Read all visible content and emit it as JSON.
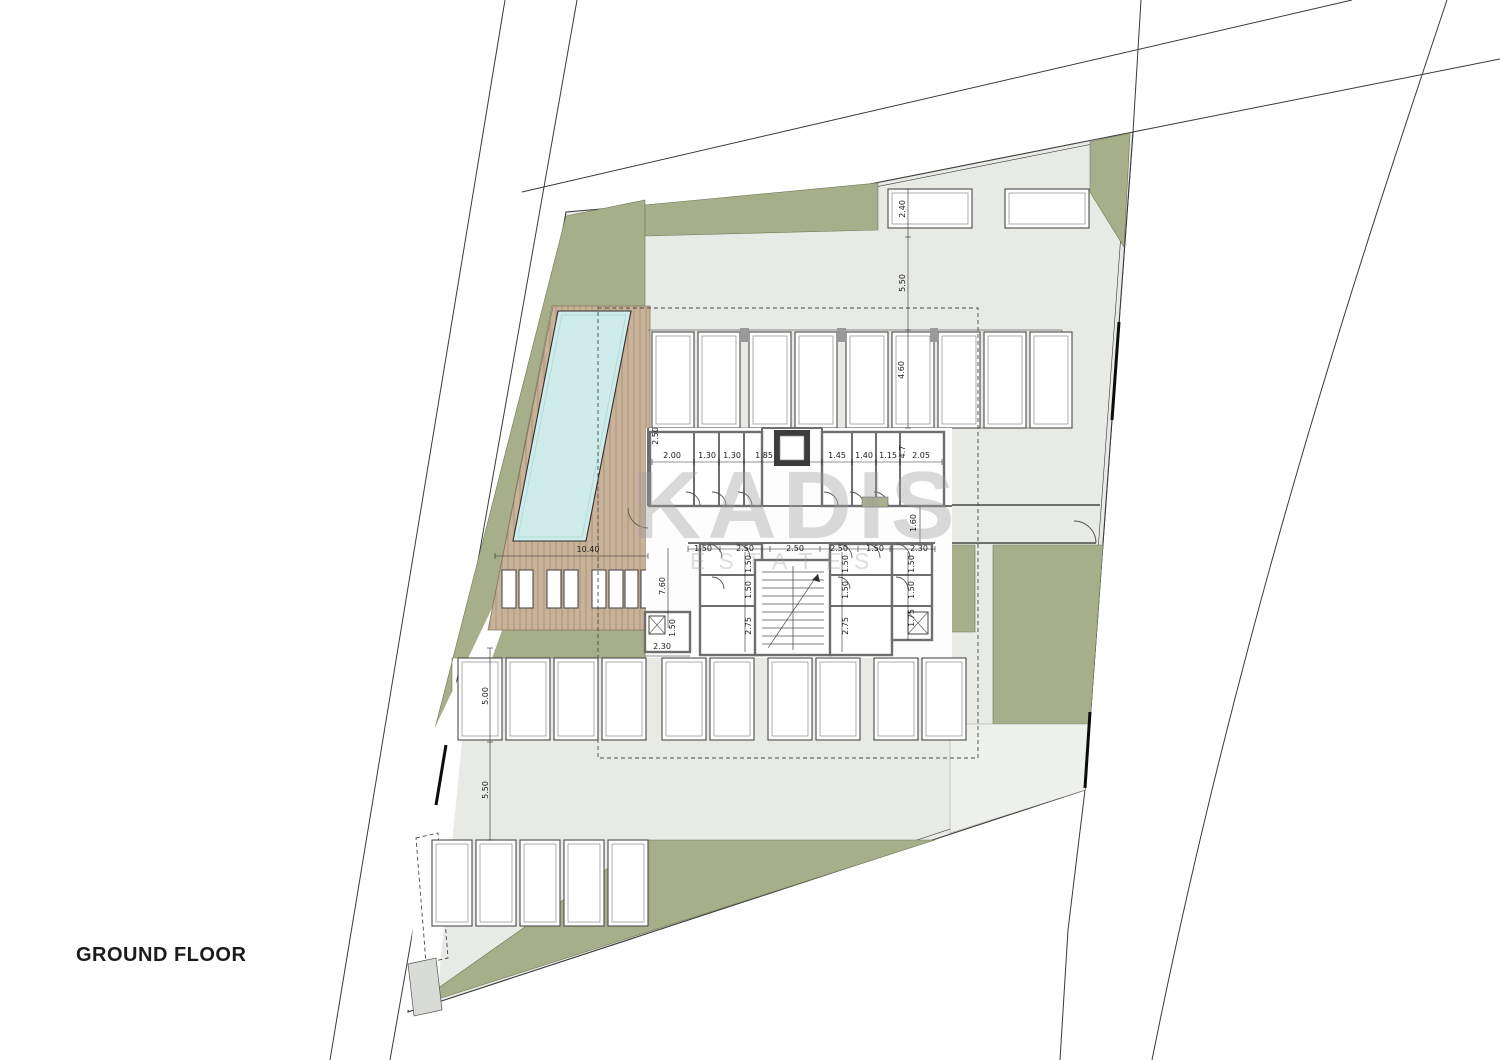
{
  "title": {
    "label": "GROUND FLOOR"
  },
  "watermark": {
    "brand": "KADIS",
    "subtitle": "ESTATES"
  },
  "colors": {
    "green": "#a6af8a",
    "paved": "#e8eae6",
    "pool": "#cfeceb",
    "deck": "#c9b29a",
    "wall": "#6e6e6e"
  },
  "dimensions": [
    {
      "text": "2.00",
      "x": 672,
      "y": 456,
      "rot": 0
    },
    {
      "text": "1.30",
      "x": 707,
      "y": 456,
      "rot": 0
    },
    {
      "text": "1.30",
      "x": 732,
      "y": 456,
      "rot": 0
    },
    {
      "text": "1.85",
      "x": 764,
      "y": 456,
      "rot": 0
    },
    {
      "text": "1.45",
      "x": 837,
      "y": 456,
      "rot": 0
    },
    {
      "text": "1.40",
      "x": 864,
      "y": 456,
      "rot": 0
    },
    {
      "text": "1.15",
      "x": 888,
      "y": 456,
      "rot": 0
    },
    {
      "text": "2.05",
      "x": 921,
      "y": 456,
      "rot": 0
    },
    {
      "text": "4.7",
      "x": 903,
      "y": 452,
      "rot": 1
    },
    {
      "text": "2.50",
      "x": 656,
      "y": 436,
      "rot": 1
    },
    {
      "text": "2.40",
      "x": 903,
      "y": 209,
      "rot": 1
    },
    {
      "text": "5.50",
      "x": 903,
      "y": 283,
      "rot": 1
    },
    {
      "text": "4.60",
      "x": 902,
      "y": 370,
      "rot": 1
    },
    {
      "text": "1.60",
      "x": 914,
      "y": 523,
      "rot": 1
    },
    {
      "text": "1.50",
      "x": 703,
      "y": 549,
      "rot": 0
    },
    {
      "text": "2.50",
      "x": 745,
      "y": 549,
      "rot": 0
    },
    {
      "text": "2.50",
      "x": 795,
      "y": 549,
      "rot": 0
    },
    {
      "text": "2.50",
      "x": 839,
      "y": 549,
      "rot": 0
    },
    {
      "text": "1.50",
      "x": 875,
      "y": 549,
      "rot": 0
    },
    {
      "text": "2.30",
      "x": 919,
      "y": 549,
      "rot": 0
    },
    {
      "text": "1.50",
      "x": 749,
      "y": 564,
      "rot": 1
    },
    {
      "text": "1.50",
      "x": 749,
      "y": 590,
      "rot": 1
    },
    {
      "text": "2.75",
      "x": 749,
      "y": 626,
      "rot": 1
    },
    {
      "text": "1.50",
      "x": 846,
      "y": 564,
      "rot": 1
    },
    {
      "text": "1.50",
      "x": 846,
      "y": 590,
      "rot": 1
    },
    {
      "text": "2.75",
      "x": 846,
      "y": 626,
      "rot": 1
    },
    {
      "text": "1.50",
      "x": 912,
      "y": 564,
      "rot": 1
    },
    {
      "text": "1.50",
      "x": 912,
      "y": 590,
      "rot": 1
    },
    {
      "text": "1.75",
      "x": 912,
      "y": 618,
      "rot": 1
    },
    {
      "text": "10.40",
      "x": 588,
      "y": 550,
      "rot": 0
    },
    {
      "text": "7.60",
      "x": 663,
      "y": 586,
      "rot": 1
    },
    {
      "text": "1.50",
      "x": 673,
      "y": 628,
      "rot": 1
    },
    {
      "text": "2.30",
      "x": 662,
      "y": 647,
      "rot": 0
    },
    {
      "text": "5.00",
      "x": 486,
      "y": 696,
      "rot": 1
    },
    {
      "text": "5.50",
      "x": 486,
      "y": 790,
      "rot": 1
    }
  ]
}
